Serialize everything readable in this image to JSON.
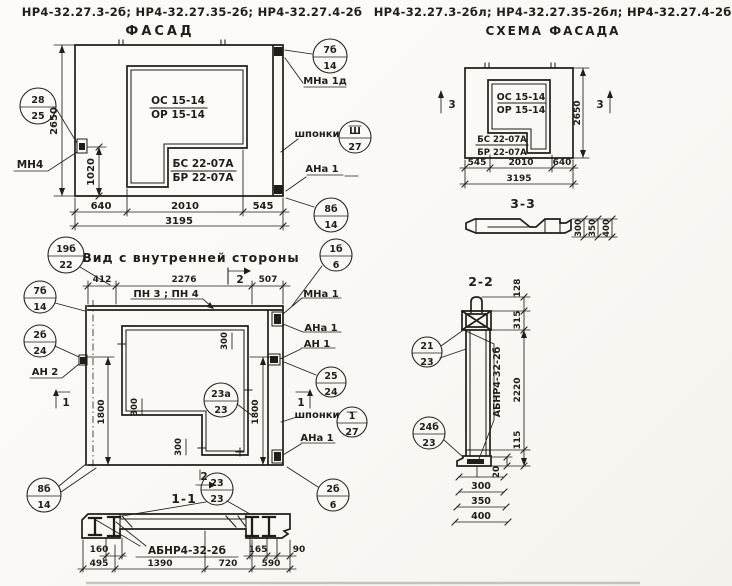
{
  "header": {
    "left_codes": "НР4-32.27.3-2б; НР4-32.27.35-2б; НР4-32.27.4-2б",
    "left_title": "ФАСАД",
    "right_codes": "НР4-32.27.3-2бл; НР4-32.27.35-2бл; НР4-32.27.4-2бл",
    "right_title": "СХЕМА ФАСАДА"
  },
  "facade": {
    "marks": {
      "os": "ОС 15-14",
      "or_mark": "ОР 15-14",
      "bs": "БС 22-07А",
      "br": "БР 22-07А"
    },
    "dims": {
      "height": "2650",
      "anchor": "1020",
      "left": "640",
      "mid": "2010",
      "right": "545",
      "total": "3195"
    },
    "labels": {
      "mn4": "МН4",
      "mna1d": "МНа 1д",
      "shponki": "шпонки",
      "ana1": "АНа 1"
    },
    "callouts": {
      "c28_25": {
        "n": "28",
        "d": "25"
      },
      "c7b_14": {
        "n": "7б",
        "d": "14"
      },
      "csh_27": {
        "n": "Ш",
        "d": "27"
      },
      "c8b_14": {
        "n": "8б",
        "d": "14"
      }
    }
  },
  "schema": {
    "marks": {
      "os": "ОС 15-14",
      "or_mark": "ОР 15-14",
      "bs": "БС 22-07А",
      "br": "БР 22-07А"
    },
    "dims": {
      "height": "2650",
      "left": "545",
      "mid": "2010",
      "right": "640",
      "total": "3195"
    },
    "section_mark": "3",
    "section33": {
      "title": "3-3",
      "dims": [
        "300",
        "350",
        "400"
      ]
    }
  },
  "view": {
    "title": "Вид с внутренней стороны",
    "dims": {
      "d412": "412",
      "d2276": "2276",
      "d507": "507",
      "d1800": "1800",
      "d300": "300"
    },
    "labels": {
      "pn": "ПН 3 ; ПН 4",
      "mna1": "МНа 1",
      "ana1": "АНа 1",
      "an1": "АН 1",
      "an2": "АН 2",
      "shponki": "шпонки"
    },
    "marks": {
      "m1": "1",
      "m2": "2"
    },
    "callouts": {
      "c19b_22": {
        "n": "19б",
        "d": "22"
      },
      "c7b_14": {
        "n": "7б",
        "d": "14"
      },
      "c2b_24": {
        "n": "2б",
        "d": "24"
      },
      "c8b_14": {
        "n": "8б",
        "d": "14"
      },
      "c1b_6": {
        "n": "1б",
        "d": "6"
      },
      "c25_24": {
        "n": "25",
        "d": "24"
      },
      "c1_27": {
        "n": "1",
        "d": "27"
      },
      "c23a_23": {
        "n": "23а",
        "d": "23"
      },
      "c2b_6": {
        "n": "2б",
        "d": "6"
      }
    }
  },
  "s11": {
    "title": "1-1",
    "label": "АБНР4-32-2б",
    "dims": {
      "d160": "160",
      "d165": "165",
      "d90": "90"
    },
    "chain": [
      "495",
      "1390",
      "720",
      "590"
    ],
    "callout": {
      "n": "23",
      "d": "23"
    }
  },
  "s22": {
    "title": "2-2",
    "label": "АБНР4-32-2б",
    "dims": {
      "d128": "128",
      "d315": "315",
      "d2220": "2220",
      "d115": "115",
      "d20": "20"
    },
    "stack": [
      "300",
      "350",
      "400"
    ],
    "callouts": {
      "c21_23": {
        "n": "21",
        "d": "23"
      },
      "c24b_23": {
        "n": "24б",
        "d": "23"
      }
    }
  }
}
